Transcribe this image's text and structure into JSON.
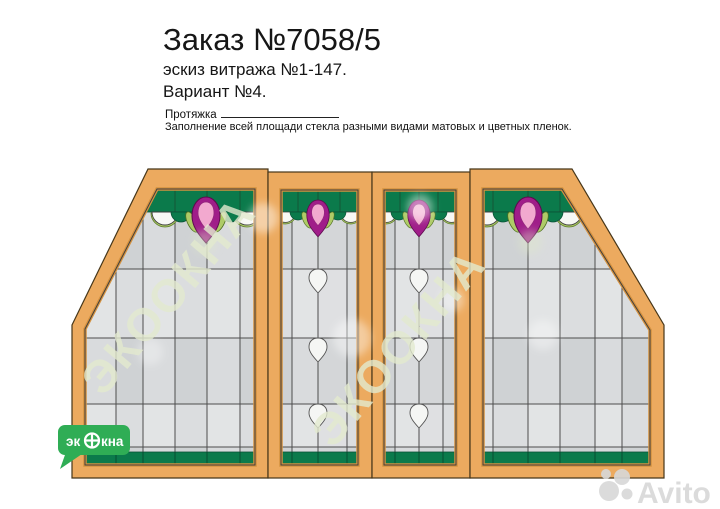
{
  "header": {
    "title": "Заказ №7058/5",
    "subtitle": "эскиз витража №1-147.",
    "variant": "Вариант №4.",
    "protyazhka_label": "Протяжка",
    "note": "Заполнение всей площади стекла разными видами матовых и цветных пленок."
  },
  "drawing": {
    "type": "stained-glass-window-sketch",
    "sections": [
      "left-trapezoid",
      "center-left-panel",
      "center-right-panel",
      "right-trapezoid"
    ],
    "colors": {
      "frame": "#ECAA5F",
      "frame_outline": "#463619",
      "dark_green": "#0B7A4B",
      "light_green": "#AECB67",
      "magenta": "#A01D89",
      "pink": "#F2A9CF",
      "glass_light": "#D9DBDD",
      "glass_shade": "#CFD2D4",
      "logo_green": "#2FAD55"
    },
    "watermark_text": "ЭКООКНА",
    "logo": {
      "text_part1": "эк",
      "text_part2": "кна",
      "symbol": "window-circle"
    },
    "avito_text": "Avito"
  }
}
